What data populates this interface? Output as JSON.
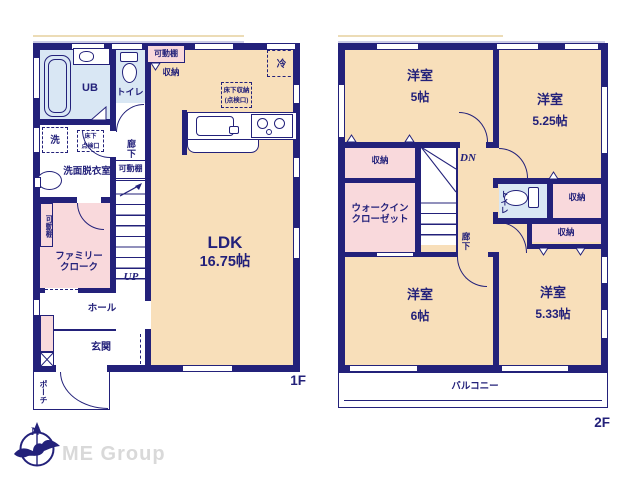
{
  "colors": {
    "wall_navy": "#23217a",
    "room_beige": "#f8dfba",
    "closet_pink": "#f9d9dc",
    "wet_blue": "#d9e7f4",
    "brand_gray": "#d9d9d9"
  },
  "compass": {
    "north": "N"
  },
  "brand": {
    "name": "ME Group"
  },
  "floor1": {
    "floor_label": "1F",
    "rooms": {
      "ub": "UB",
      "toilet": "トイレ",
      "shelf_top": "可動棚",
      "storage_top": "収納",
      "fridge": "冷",
      "underfloor_kitchen_line1": "床下収納",
      "underfloor_kitchen_line2": "(点検口)",
      "washer": "洗",
      "underfloor_hatch_line1": "床下",
      "underfloor_hatch_line2": "点検口",
      "corridor": "廊下",
      "shelf_mid": "可動棚",
      "washroom": "洗面脱衣室",
      "shelf_left": "可動棚",
      "family_closet_line1": "ファミリー",
      "family_closet_line2": "クローク",
      "stairs_up": "UP",
      "hall": "ホール",
      "entrance": "玄関",
      "porch": "ポーチ",
      "ldk_name": "LDK",
      "ldk_size": "16.75帖"
    }
  },
  "floor2": {
    "floor_label": "2F",
    "rooms": {
      "room_nw_name": "洋室",
      "room_nw_size": "5帖",
      "room_ne_name": "洋室",
      "room_ne_size": "5.25帖",
      "storage_w": "収納",
      "wic_line1": "ウォークイン",
      "wic_line2": "クローゼット",
      "stairs_down": "DN",
      "toilet": "トイレ",
      "storage_e1": "収納",
      "storage_e2": "収納",
      "corridor": "廊下",
      "room_sw_name": "洋室",
      "room_sw_size": "6帖",
      "room_se_name": "洋室",
      "room_se_size": "5.33帖",
      "balcony": "バルコニー"
    }
  }
}
